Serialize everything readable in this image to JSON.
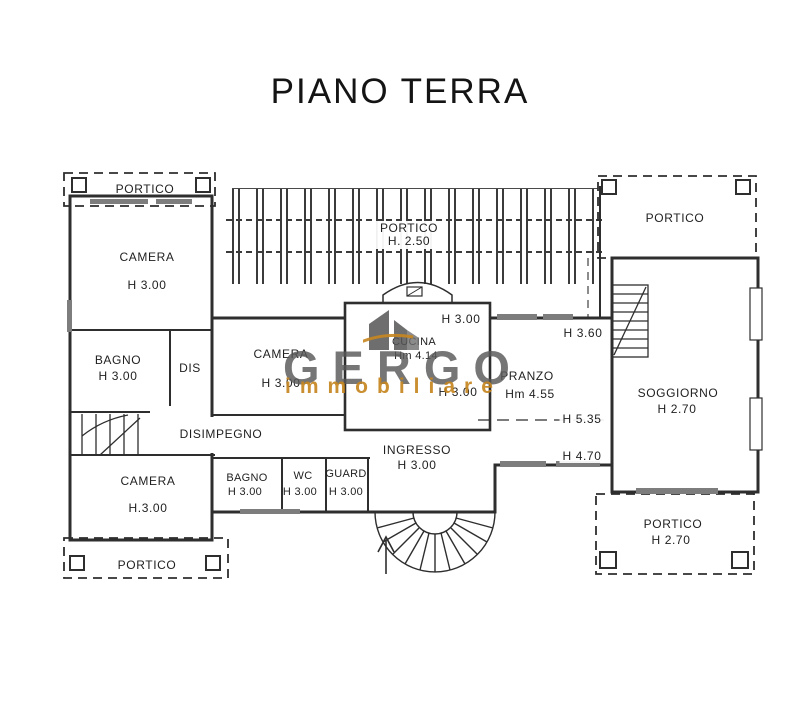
{
  "title": "PIANO TERRA",
  "watermark": {
    "brand": "GERGO",
    "tagline": "immobiliare",
    "brand_color": "#585858",
    "tagline_color": "#c6861f"
  },
  "colors": {
    "wall_line": "#2e2e2e",
    "background": "#ffffff"
  },
  "rooms": {
    "portico_top_left": {
      "label": "PORTICO"
    },
    "camera_top_left": {
      "label": "CAMERA",
      "height": "H 3.00"
    },
    "bagno_left": {
      "label": "BAGNO",
      "height": "H 3.00"
    },
    "dis": {
      "label": "DIS"
    },
    "camera_center": {
      "label": "CAMERA",
      "height": "H 3.00"
    },
    "disimpegno": {
      "label": "DISIMPEGNO"
    },
    "camera_bottom_left": {
      "label": "CAMERA",
      "height": "H.3.00"
    },
    "portico_bottom_left": {
      "label": "PORTICO"
    },
    "portico_center": {
      "label": "PORTICO",
      "height": "H. 2.50"
    },
    "cucina": {
      "label": "CUCINA",
      "height": "Hm 4.14"
    },
    "pranzo": {
      "label": "PRANZO",
      "height": "Hm 4.55"
    },
    "ingresso": {
      "label": "INGRESSO",
      "height": "H 3.00"
    },
    "bagno_center": {
      "label": "BAGNO",
      "height": "H 3.00"
    },
    "wc": {
      "label": "WC",
      "height": "H 3.00"
    },
    "guard": {
      "label": "GUARD",
      "height": "H 3.00"
    },
    "soggiorno": {
      "label": "SOGGIORNO",
      "height": "H 2.70"
    },
    "portico_top_right": {
      "label": "PORTICO"
    },
    "portico_bottom_right": {
      "label": "PORTICO",
      "height": "H 2.70"
    }
  },
  "annotations": {
    "h_top": "H 3.00",
    "h_veranda_right": "H 3.60",
    "h_ridge": "H 5.35",
    "h_eaves": "H 4.70",
    "h_mid": "H 3.00"
  }
}
